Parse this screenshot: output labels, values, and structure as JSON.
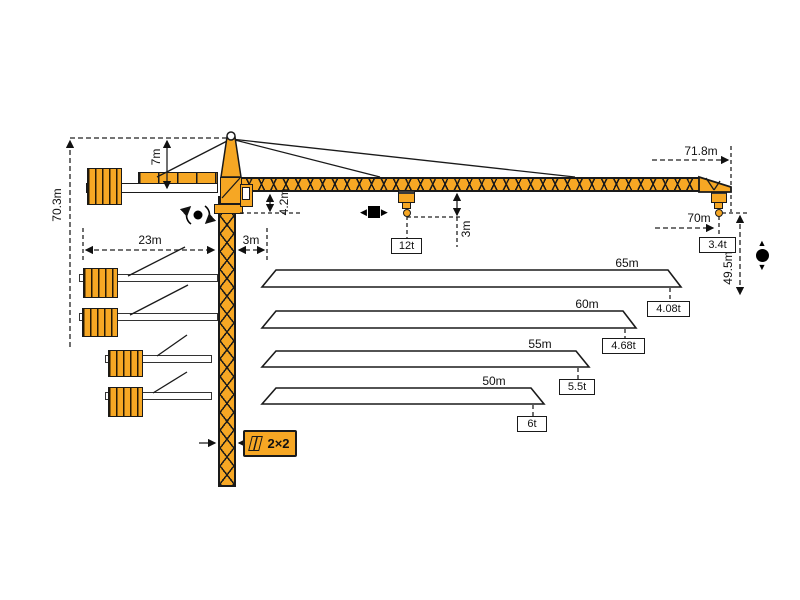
{
  "colors": {
    "crane_yellow": "#F6A724",
    "outline": "#1A1A1A",
    "background": "#FFFFFF"
  },
  "dimensions": {
    "total_height": "70.3m",
    "tower_head_height": "7m",
    "counter_jib_length": "23m",
    "rear_offset": "3m",
    "jib_section_height": "4.2m",
    "max_capacity": "12t",
    "hook_to_jib": "3m",
    "tip_radius": "71.8m",
    "max_hook_radius": "70m",
    "tip_capacity": "3.4t",
    "lift_height": "49.5m",
    "mast_section": "2×2"
  },
  "jib_variants": [
    {
      "length": "65m",
      "tip_load": "4.08t"
    },
    {
      "length": "60m",
      "tip_load": "4.68t"
    },
    {
      "length": "55m",
      "tip_load": "5.5t"
    },
    {
      "length": "50m",
      "tip_load": "6t"
    }
  ],
  "icons": {
    "trolley_left": "◀",
    "trolley_right": "▶",
    "hoist_up": "▲",
    "hoist_down": "▼"
  }
}
